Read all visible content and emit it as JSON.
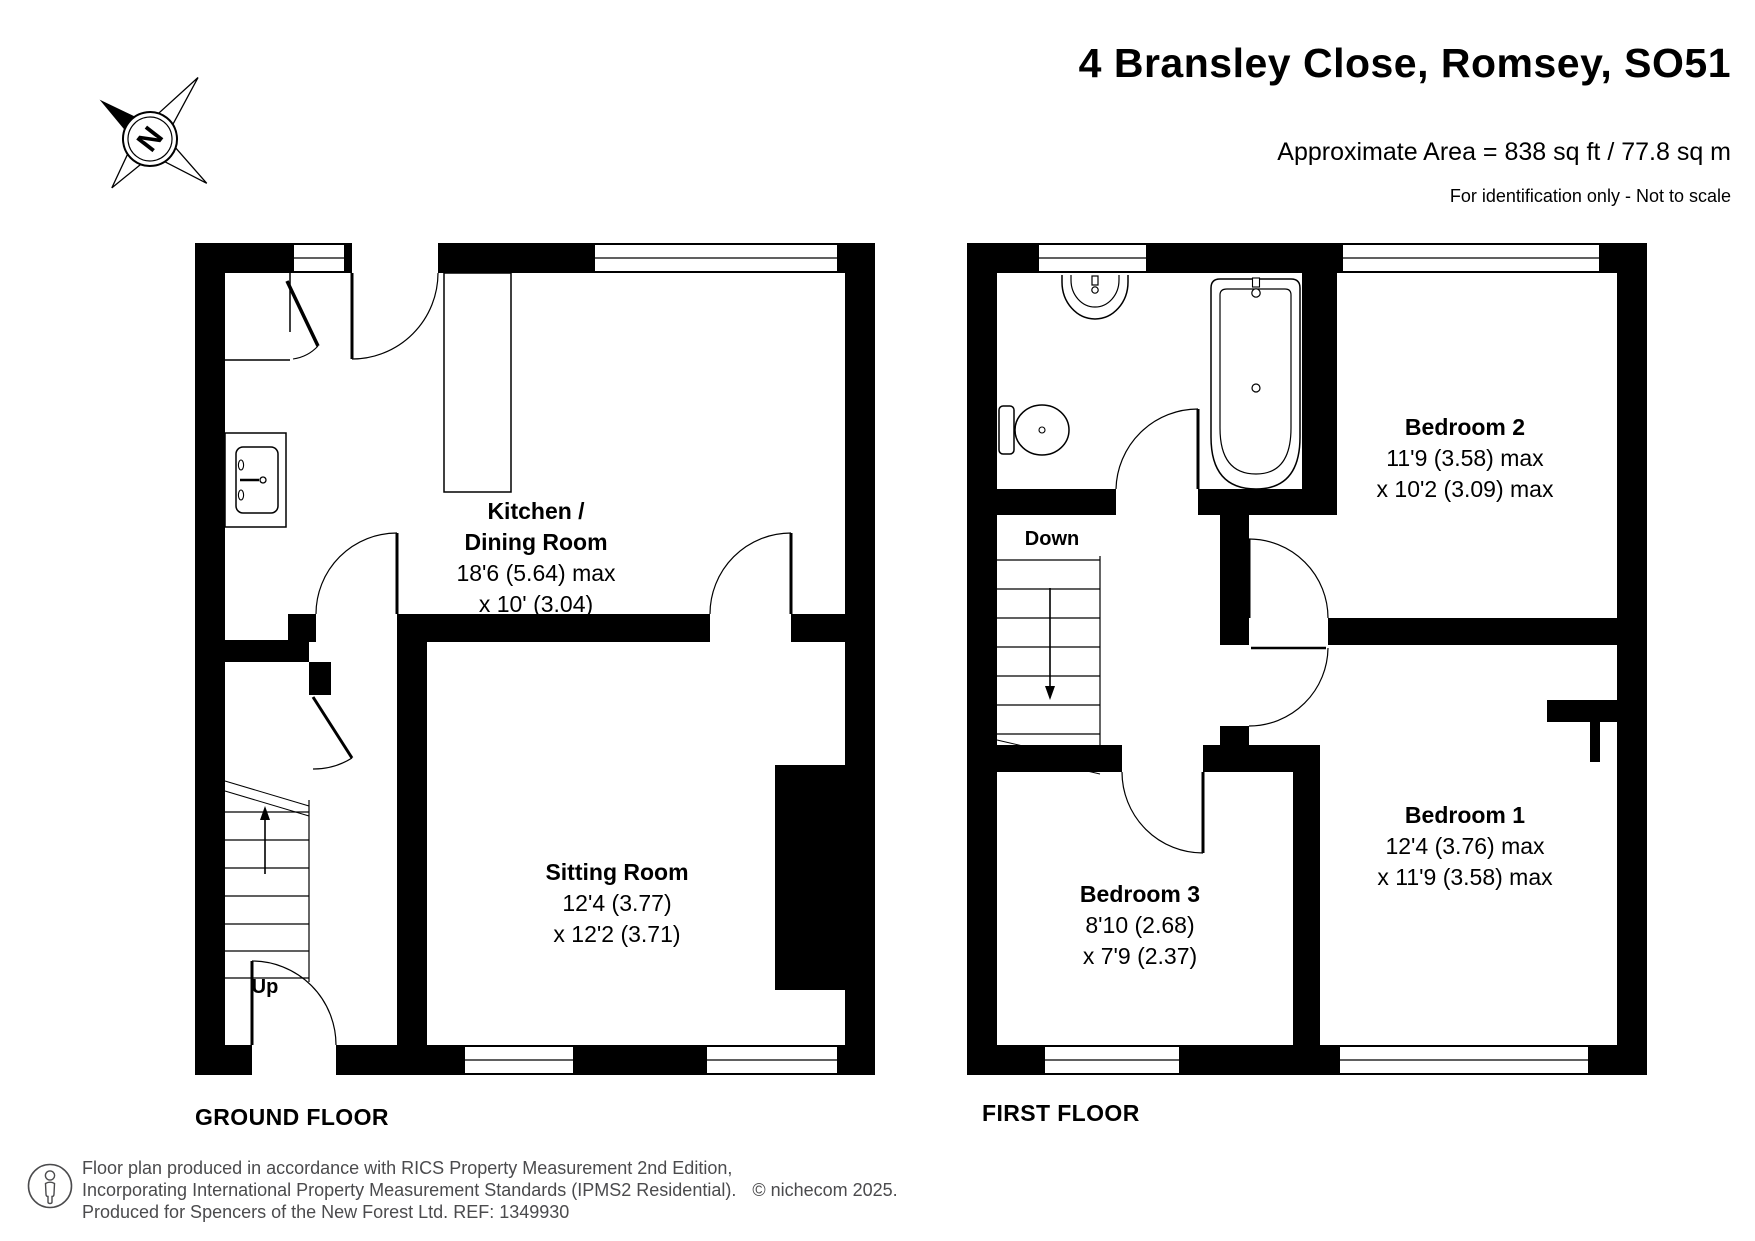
{
  "header": {
    "title": "4 Bransley Close, Romsey, SO51",
    "area": "Approximate Area = 838 sq ft / 77.8 sq m",
    "disclaimer": "For identification only - Not to scale"
  },
  "compass": {
    "north": "N"
  },
  "ground_floor": {
    "label": "GROUND FLOOR",
    "stairs_label": "Up",
    "kitchen": {
      "name1": "Kitchen /",
      "name2": "Dining Room",
      "dim1": "18'6 (5.64) max",
      "dim2": "x 10' (3.04)"
    },
    "sitting_room": {
      "name": "Sitting Room",
      "dim1": "12'4 (3.77)",
      "dim2": "x 12'2 (3.71)"
    }
  },
  "first_floor": {
    "label": "FIRST FLOOR",
    "stairs_label": "Down",
    "bedroom1": {
      "name": "Bedroom 1",
      "dim1": "12'4 (3.76) max",
      "dim2": "x 11'9 (3.58) max"
    },
    "bedroom2": {
      "name": "Bedroom 2",
      "dim1": "11'9 (3.58) max",
      "dim2": "x 10'2 (3.09) max"
    },
    "bedroom3": {
      "name": "Bedroom 3",
      "dim1": "8'10 (2.68)",
      "dim2": "x 7'9 (2.37)"
    }
  },
  "footer": {
    "line1": "Floor plan produced in accordance with RICS Property Measurement 2nd Edition,",
    "line2": "Incorporating International Property Measurement Standards (IPMS2 Residential).",
    "copyright": "© nichecom 2025.",
    "line3": "Produced for Spencers of the New Forest Ltd.   REF:  1349930"
  }
}
